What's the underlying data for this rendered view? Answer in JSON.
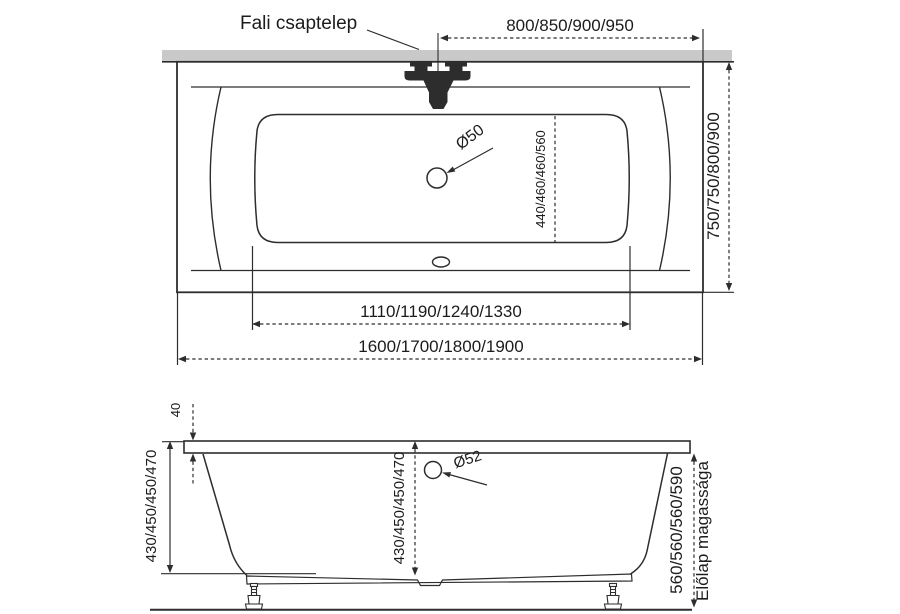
{
  "colors": {
    "background": "#ffffff",
    "line": "#2d2d2d",
    "wall_band": "#c9c9c9",
    "text": "#1c1c1c"
  },
  "top_view": {
    "faucet_label": "Fali csaptelep",
    "dim_faucet_offset": "800/850/900/950",
    "dim_width": "750/750/800/900",
    "dim_drain_position": "440/460/460/560",
    "label_drain_diameter": "Ø50",
    "dim_basin_length": "1110/1190/1240/1330",
    "dim_overall_length": "1600/1700/1800/1900"
  },
  "side_view": {
    "dim_rim_thickness": "40",
    "dim_depth_outer": "430/450/450/470",
    "dim_depth_inner": "430/450/450/470",
    "label_overflow_diameter": "Ø52",
    "dim_front_panel_height": "560/560/560/590",
    "label_front_panel": "Előlap magassága"
  }
}
